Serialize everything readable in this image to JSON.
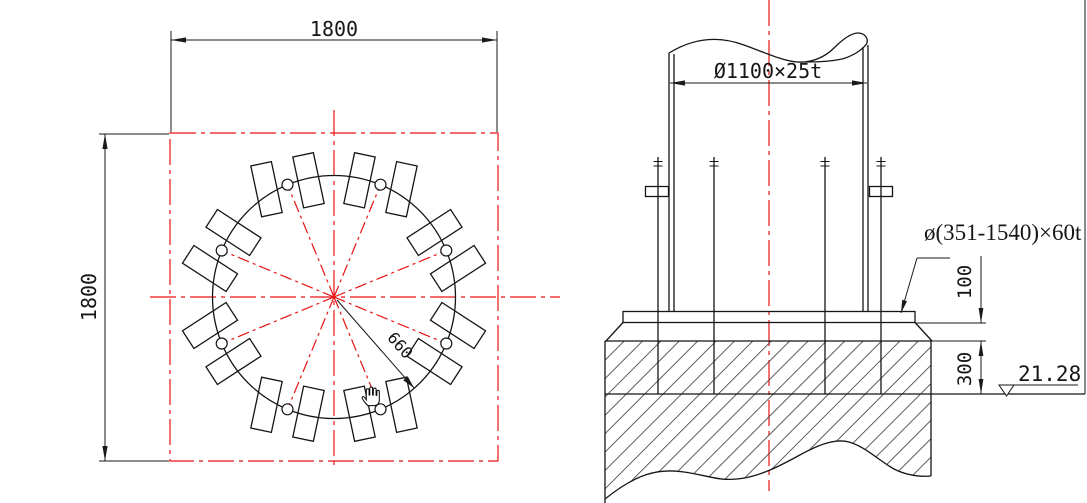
{
  "colors": {
    "line": "#151515",
    "centerline_red": "#e81414",
    "background": "#ffffff"
  },
  "plan_view": {
    "title_hint": "anchor bolt arrangement plan",
    "dim_width_label": "1800",
    "dim_height_label": "1800",
    "bolt_circle_radius_label": "660",
    "bolt_hole_count": 8,
    "anchor_plate_count": 16,
    "geometry": {
      "cx": 334,
      "cy": 297,
      "bolt_circle_r": 121.5,
      "hole_r": 5.5,
      "hole_angles_deg": [
        22.5,
        67.5,
        112.5,
        157.5,
        202.5,
        247.5,
        292.5,
        337.5
      ],
      "plate_len": 52,
      "plate_w": 21,
      "pair_offset": 21.5,
      "twist_deg": 10.5,
      "square": {
        "x": 170,
        "y": 133,
        "w": 328,
        "h": 328
      }
    }
  },
  "elevation_view": {
    "title_hint": "column base elevation section",
    "pipe_dim_label": "Ø1100×25t",
    "base_plate_label": "ø(351-1540)×60t",
    "grout_dim_label": "100",
    "embed_dim_label": "300",
    "level_label": "21.28"
  },
  "cursor": {
    "kind": "hand-cursor"
  }
}
